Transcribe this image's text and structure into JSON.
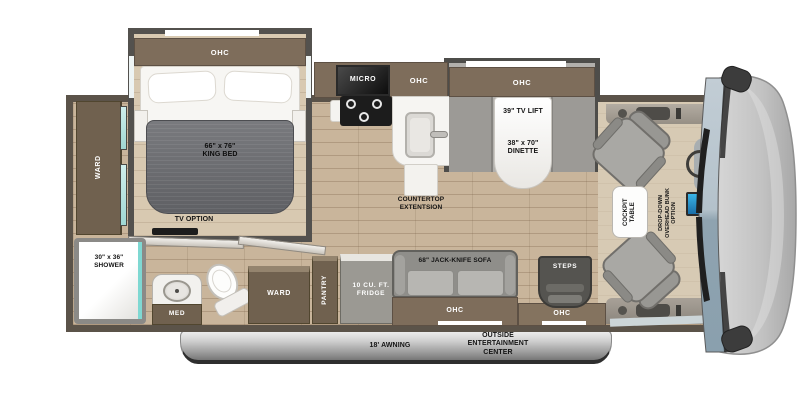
{
  "colors": {
    "wood_floor": "#c9b59b",
    "slide_floor": "#d8c9b1",
    "cabinet_brown": "#7e6d5b",
    "wall": "#5b5349",
    "teal_glass": "#7fd8d2",
    "windshield_top": "#bfcad2",
    "windshield_bottom": "#8ea2af",
    "awning_gray": "#9e9e9e"
  },
  "bedroom": {
    "ohc": "OHC",
    "bed": "66\" x 76\"\nKING BED",
    "ward": "WARD",
    "tv_option": "TV OPTION"
  },
  "bath": {
    "shower": "30\" x 36\"\nSHOWER",
    "med": "MED"
  },
  "kitchen": {
    "micro": "MICRO",
    "ohc": "OHC",
    "countertop": "COUNTERTOP\nEXTENTSION"
  },
  "dinette": {
    "ohc": "OHC",
    "tv_lift": "39\" TV LIFT",
    "size": "38\" x 70\"\nDINETTE"
  },
  "storage": {
    "ward": "WARD",
    "pantry": "PANTRY",
    "fridge": "10 CU. FT.\nFRIDGE"
  },
  "living": {
    "sofa": "68\" JACK-KNIFE SOFA",
    "ohc": "OHC"
  },
  "entry": {
    "steps": "STEPS",
    "ohc": "OHC"
  },
  "cockpit": {
    "table": "COCKPIT\nTABLE",
    "bunk_option": "DROP-DOWN\nOVERHEAD BUNK\nOPTION"
  },
  "exterior": {
    "awning": "18' AWNING",
    "entertainment": "OUTSIDE\nENTERTAINMENT\nCENTER"
  }
}
